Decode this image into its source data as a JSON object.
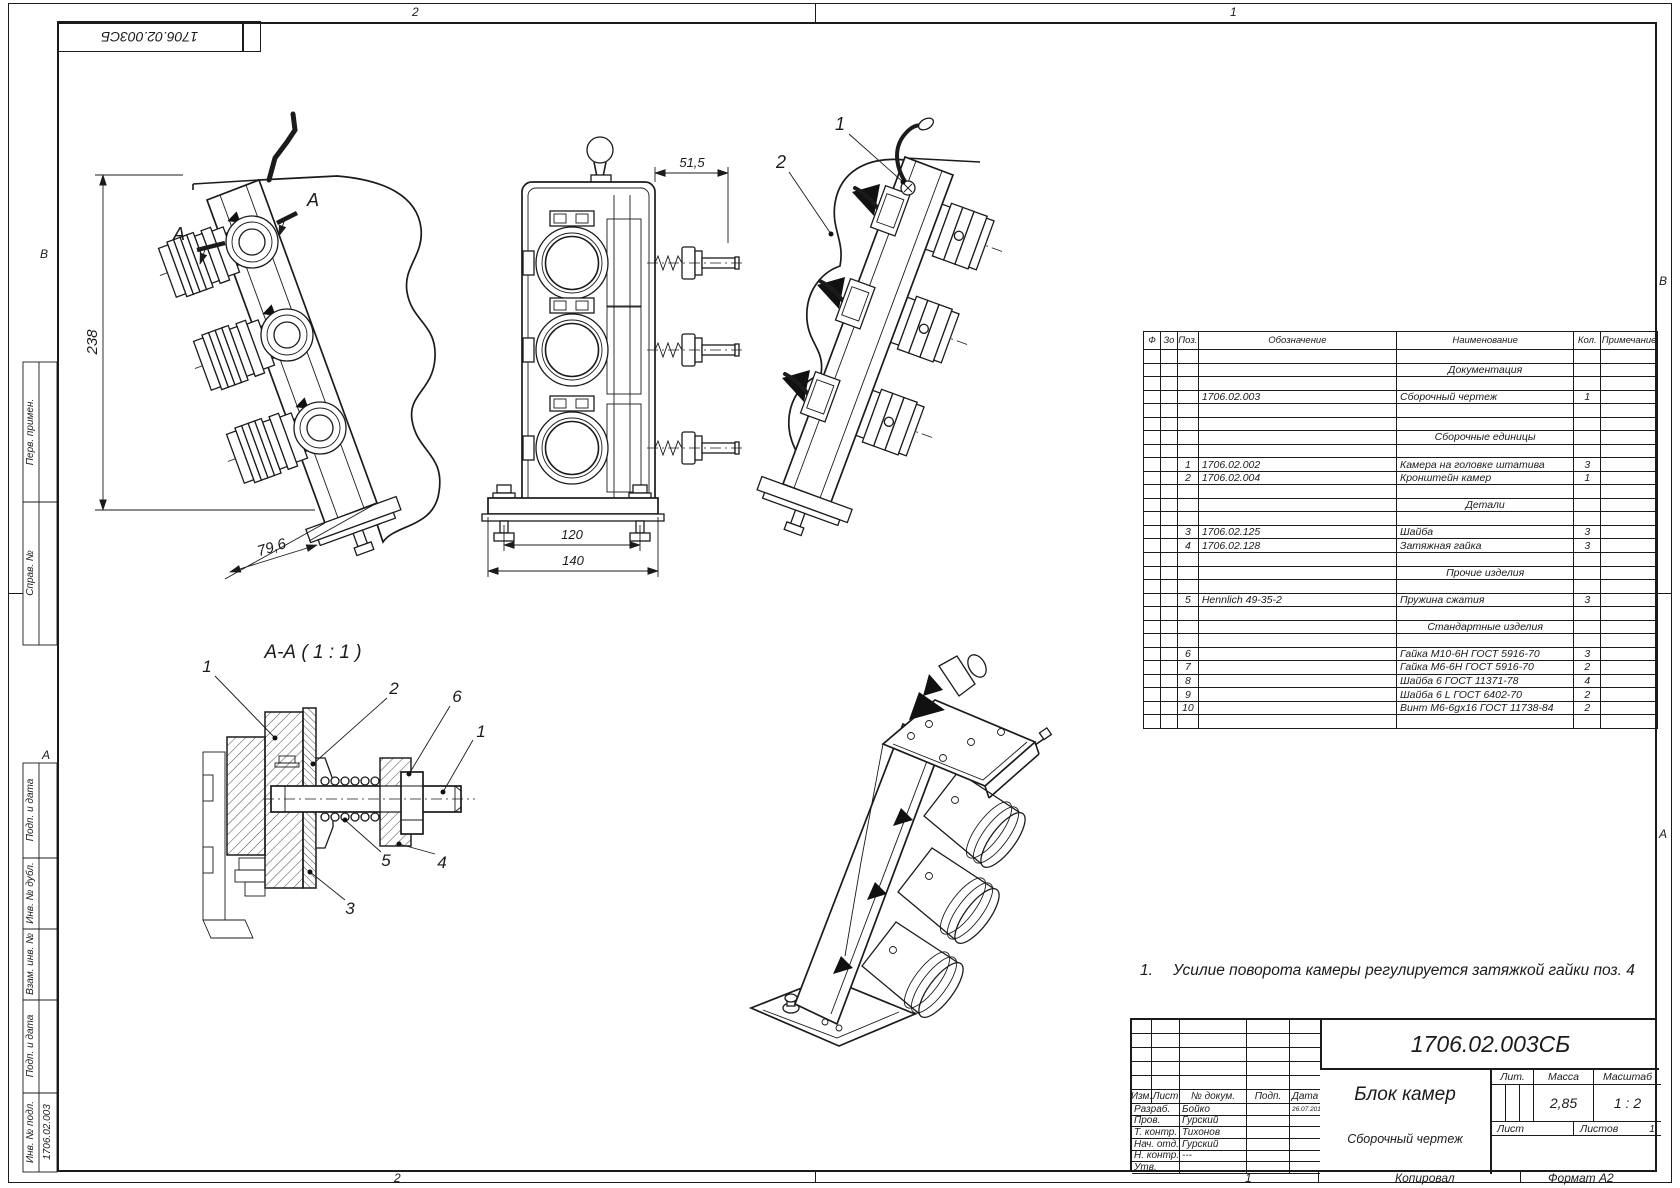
{
  "frame": {
    "zone_top_left": "2",
    "zone_top_right": "1",
    "zone_bottom_left": "2",
    "zone_bottom_right": "1",
    "zone_left_top": "В",
    "zone_left_bottom": "А",
    "zone_right_top": "В",
    "zone_right_bottom": "А",
    "copied_label": "Копировал",
    "format_label": "Формат А2"
  },
  "corner_stamp": {
    "doc_number": "1706.02.003СБ"
  },
  "margin_stamps": {
    "perv_primen": "Перв. примен.",
    "sprav_no": "Справ. №",
    "podp_data_1": "Подп. и дата",
    "inv_no_dubl": "Инв. № дубл.",
    "vzam_inv_no": "Взам. инв. №",
    "podp_data_2": "Подп. и дата",
    "inv_no_podl": "Инв. № подл.",
    "inv_no_podl_value": "1706.02.003"
  },
  "views": {
    "side_view": {
      "dim_height": "238",
      "dim_width": "79,6",
      "section_letter_1": "А",
      "section_letter_2": "А"
    },
    "front_view": {
      "dim_offset": "51,5",
      "dim_bolts": "120",
      "dim_base": "140"
    },
    "rear_view": {
      "callout_1": "1",
      "callout_2": "2"
    },
    "section_view": {
      "title": "А-А ( 1 : 1 )",
      "callout_1": "1",
      "callout_1b": "1",
      "callout_2": "2",
      "callout_3": "3",
      "callout_4": "4",
      "callout_5": "5",
      "callout_6": "6"
    }
  },
  "note": {
    "number": "1.",
    "text": "Усилие поворота камеры регулируется затяжкой гайки поз. 4"
  },
  "spec_table": {
    "headers": [
      "Ф",
      "Зо",
      "Поз.",
      "Обозначение",
      "Наименование",
      "Кол.",
      "Примечание"
    ],
    "rows": [
      {},
      {
        "name": "Документация",
        "center": true
      },
      {},
      {
        "desig": "1706.02.003",
        "name": "Сборочный чертеж",
        "qty": "1"
      },
      {},
      {},
      {
        "name": "Сборочные единицы",
        "center": true
      },
      {},
      {
        "pos": "1",
        "desig": "1706.02.002",
        "name": "Камера на головке штатива",
        "qty": "3"
      },
      {
        "pos": "2",
        "desig": "1706.02.004",
        "name": "Кронштейн камер",
        "qty": "1"
      },
      {},
      {
        "name": "Детали",
        "center": true
      },
      {},
      {
        "pos": "3",
        "desig": "1706.02.125",
        "name": "Шайба",
        "qty": "3"
      },
      {
        "pos": "4",
        "desig": "1706.02.128",
        "name": "Затяжная гайка",
        "qty": "3"
      },
      {},
      {
        "name": "Прочие изделия",
        "center": true
      },
      {},
      {
        "pos": "5",
        "desig": "Hennlich 49-35-2",
        "name": "Пружина сжатия",
        "qty": "3"
      },
      {},
      {
        "name": "Стандартные изделия",
        "center": true
      },
      {},
      {
        "pos": "6",
        "name": "Гайка М10-6Н ГОСТ 5916-70",
        "qty": "3"
      },
      {
        "pos": "7",
        "name": "Гайка М6-6Н ГОСТ 5916-70",
        "qty": "2"
      },
      {
        "pos": "8",
        "name": "Шайба 6 ГОСТ 11371-78",
        "qty": "4"
      },
      {
        "pos": "9",
        "name": "Шайба  6 L ГОСТ 6402-70",
        "qty": "2"
      },
      {
        "pos": "10",
        "name": "Винт М6-6gx16 ГОСТ 11738-84",
        "qty": "2"
      },
      {}
    ]
  },
  "title_block": {
    "doc_number": "1706.02.003СБ",
    "product_name": "Блок камер",
    "doc_type": "Сборочный чертеж",
    "header_cols": [
      "Изм.",
      "Лист",
      "№ докум.",
      "Подп.",
      "Дата"
    ],
    "sign_rows": [
      {
        "role": "Разраб.",
        "name": "Бойко",
        "date": "26.07.2017"
      },
      {
        "role": "Пров.",
        "name": "Гурский",
        "date": ""
      },
      {
        "role": "Т. контр.",
        "name": "Тихонов",
        "date": ""
      },
      {
        "role": "Нач. отд.",
        "name": "Гурский",
        "date": ""
      },
      {
        "role": "Н. контр.",
        "name": "---",
        "date": ""
      },
      {
        "role": "Утв.",
        "name": "",
        "date": ""
      }
    ],
    "lit_label": "Лит.",
    "mass_label": "Масса",
    "scale_label": "Масштаб",
    "mass_value": "2,85",
    "scale_value": "1 : 2",
    "sheet_label": "Лист",
    "sheets_label": "Листов",
    "sheets_value": "1"
  }
}
